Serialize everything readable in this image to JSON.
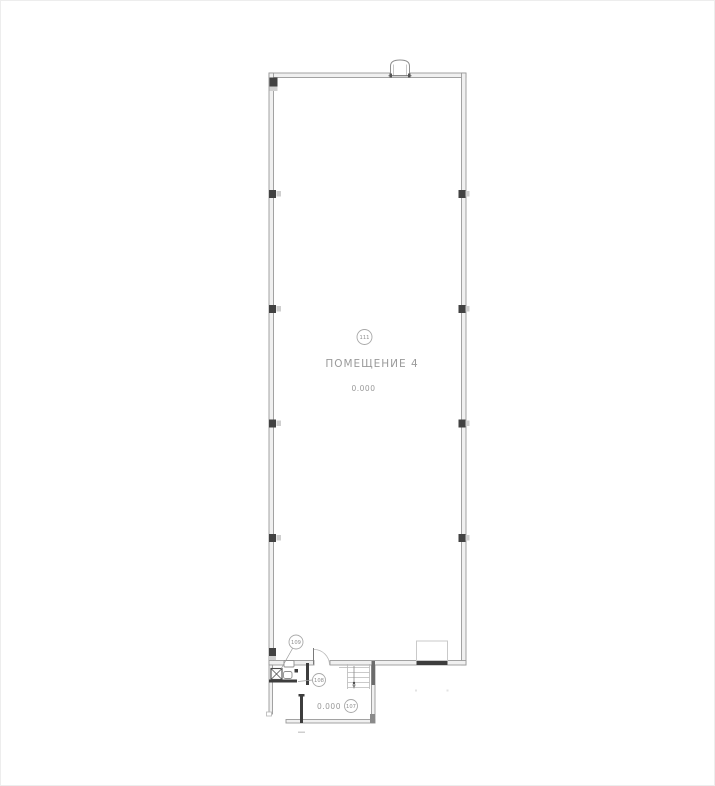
{
  "page": {
    "background": "#ffffff"
  },
  "plan": {
    "hall": {
      "room_number": "111",
      "room_name": "ПОМЕЩЕНИЕ 4",
      "elevation": "0.000"
    },
    "annex": {
      "elevation": "0.000",
      "rooms": [
        {
          "number": "109"
        },
        {
          "number": "108"
        },
        {
          "number": "107"
        }
      ]
    },
    "colors": {
      "wall_line": "#9a9a9a",
      "wall_fill": "#f0f0f0",
      "dark_wall": "#3d3d3d",
      "annotation_text": "#959595",
      "light_detail": "#c9c9c9",
      "background": "#ffffff"
    }
  }
}
